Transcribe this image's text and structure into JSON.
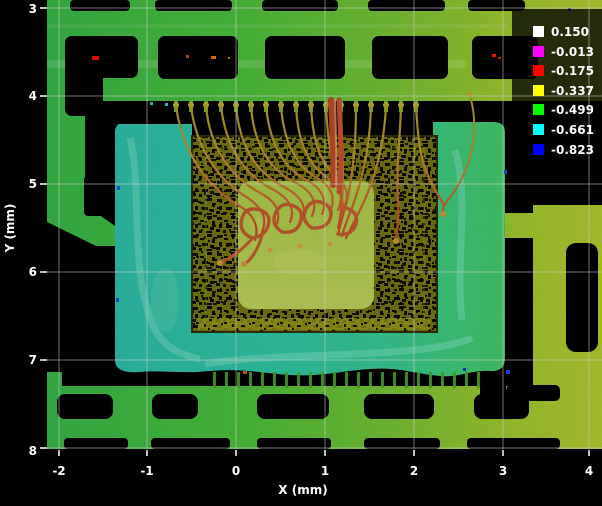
{
  "window": {
    "background": "#000000"
  },
  "axes": {
    "x_label": "X (mm)",
    "y_label": "Y (mm)",
    "x_ticks": [
      "-2",
      "-1",
      "0",
      "1",
      "2",
      "3",
      "4"
    ],
    "y_ticks": [
      "3",
      "4",
      "5",
      "6",
      "7",
      "8"
    ]
  },
  "legend": {
    "entries": [
      {
        "label": "0.150",
        "color": "#ffffff"
      },
      {
        "label": "-0.013",
        "color": "#ff00ff"
      },
      {
        "label": "-0.175",
        "color": "#ff0000"
      },
      {
        "label": "-0.337",
        "color": "#ffff00"
      },
      {
        "label": "-0.499",
        "color": "#00ff00"
      },
      {
        "label": "-0.661",
        "color": "#00ffff"
      },
      {
        "label": "-0.823",
        "color": "#0000ff"
      }
    ]
  },
  "chart_data": {
    "type": "heatmap",
    "title": "",
    "xlabel": "X (mm)",
    "ylabel": "Y (mm)",
    "xlim": [
      -2.15,
      4.15
    ],
    "ylim": [
      8.0,
      2.9
    ],
    "x_ticks": [
      -2,
      -1,
      0,
      1,
      2,
      3,
      4
    ],
    "y_ticks": [
      3,
      4,
      5,
      6,
      7,
      8
    ],
    "grid": true,
    "legend_position": "top-right",
    "units": "mm",
    "color_scale": [
      {
        "value": 0.15,
        "color": "#ffffff"
      },
      {
        "value": -0.013,
        "color": "#ff00ff"
      },
      {
        "value": -0.175,
        "color": "#ff0000"
      },
      {
        "value": -0.337,
        "color": "#ffff00"
      },
      {
        "value": -0.499,
        "color": "#00ff00"
      },
      {
        "value": -0.661,
        "color": "#00ffff"
      },
      {
        "value": -0.823,
        "color": "#0000ff"
      }
    ],
    "description": "Height-encoded overlay image of an IC package: yellow-green leadframe grid with dark rectangular openings, a teal-to-green die-attach pad spanning roughly X=-1.3..3 / Y=4.3..7.2, an olive speckled die with a bright yellow-green bond pad at its center, and red-orange bond wires fanning from the top finger row down onto the die."
  },
  "scene_colors": {
    "leadframe_left": "#4cc13c",
    "leadframe_right": "#b4cb2f",
    "pad_left": "#2ec0ac",
    "pad_right": "#46cb6a",
    "die": "#76760e",
    "die_pad": "#b4cc50",
    "wire_top": "#a6a226",
    "wire_bottom": "#c43826",
    "gridline": "#d0d0d0"
  }
}
